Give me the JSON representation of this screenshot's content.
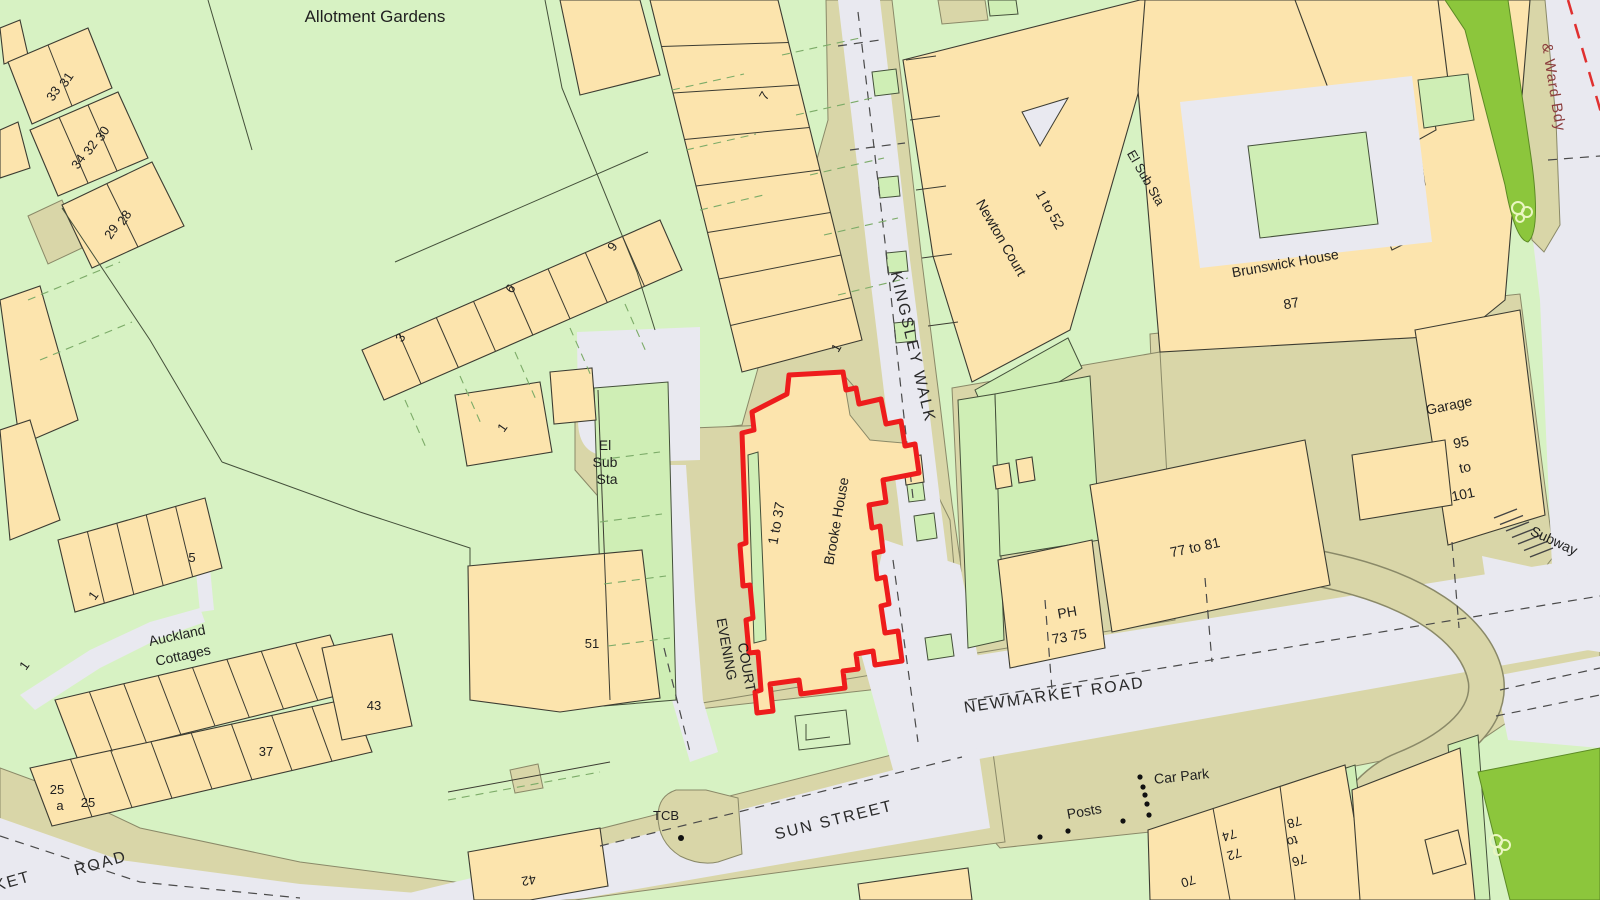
{
  "map": {
    "title": "OS-style site location plan",
    "labels": {
      "allotment_gardens": "Allotment Gardens",
      "ward_bdy": "& Ward Bdy",
      "kingsley_walk": "KINGSLEY WALK",
      "newton_court": "Newton Court",
      "newton_court_range": "1 to 52",
      "el_sub_sta": "El Sub Sta",
      "el": "El",
      "sub": "Sub",
      "sta": "Sta",
      "brunswick_house": "Brunswick House",
      "brooke_house": "Brooke House",
      "brooke_range": "1 to 37",
      "garage": "Garage",
      "subway": "Subway",
      "newmarket_road": "NEWMARKET ROAD",
      "sun_street": "SUN STREET",
      "road_partial_ket": "KET",
      "road_partial_road": "ROAD",
      "evening": "EVENING",
      "court": "COURT",
      "auckland": "Auckland",
      "cottages": "Cottages",
      "car_park": "Car Park",
      "posts": "Posts",
      "tcb": "TCB",
      "ph": "PH",
      "ph_range": "73 75",
      "n77_81": "77 to 81",
      "to": "to",
      "n1": "1",
      "n3": "3",
      "n5": "5",
      "n6": "6",
      "n7": "7",
      "n9": "9",
      "n25": "25",
      "a": "a",
      "n28": "28",
      "n29": "29",
      "n30": "30",
      "n31": "31",
      "n32": "32",
      "n33": "33",
      "n34": "34",
      "n37": "37",
      "n42": "42",
      "n43": "43",
      "n51": "51",
      "n70": "70",
      "n72": "72",
      "n74": "74",
      "n76": "76",
      "n78": "78",
      "n87": "87",
      "n95": "95",
      "n101": "101"
    },
    "colors": {
      "garden_base": "#d7f2c3",
      "garden_plot": "#cfeeb5",
      "building": "#fce4ad",
      "yard": "#d9d6a8",
      "road": "#e9e9f0",
      "verge_green": "#8cc63c",
      "boundary_red": "#ee1c1c",
      "ward_text": "#8b3d3d"
    }
  }
}
